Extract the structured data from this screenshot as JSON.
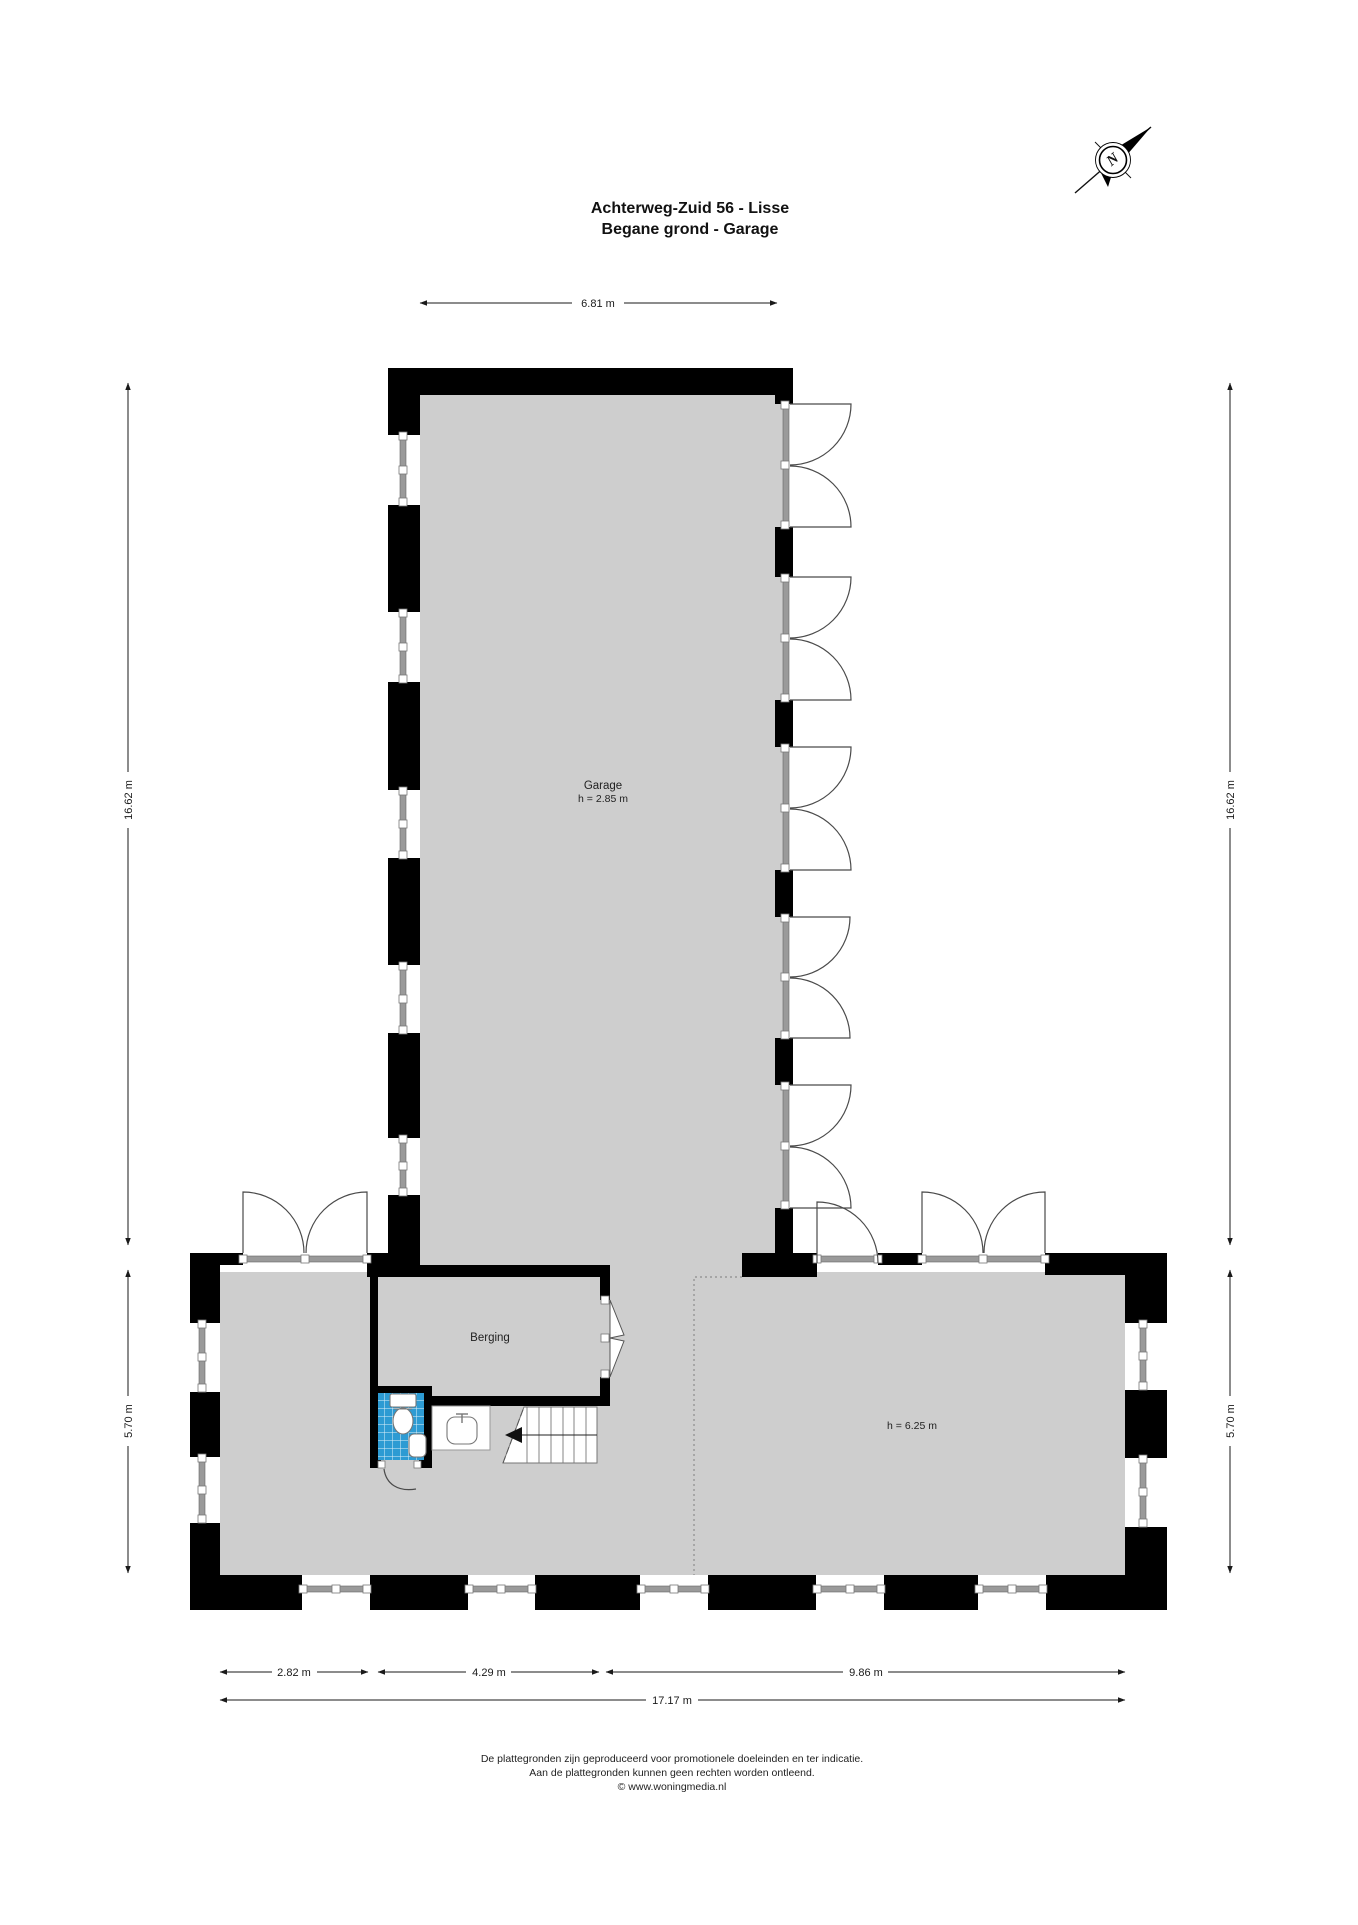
{
  "title": {
    "line1": "Achterweg-Zuid 56 - Lisse",
    "line2": "Begane grond - Garage"
  },
  "compass": {
    "north_label": "N"
  },
  "rooms": {
    "garage": {
      "name": "Garage",
      "height": "h = 2.85 m"
    },
    "berging": {
      "name": "Berging"
    },
    "hall": {
      "height": "h = 6.25 m"
    }
  },
  "dimensions": {
    "top": "6.81 m",
    "side_upper": "16.62 m",
    "side_lower": "5.70 m",
    "bottom_1": "2.82 m",
    "bottom_2": "4.29 m",
    "bottom_3": "9.86 m",
    "bottom_total": "17.17 m"
  },
  "footer": {
    "line1": "De plattegronden zijn geproduceerd voor promotionele doeleinden en ter indicatie.",
    "line2": "Aan de plattegronden kunnen geen rechten worden ontleend.",
    "line3": "© www.woningmedia.nl"
  },
  "colors": {
    "floor": "#cecece",
    "wall": "#000000",
    "tile": "#2d9bd3",
    "window_line": "#8a8a8a",
    "dim": "#1a1a1a",
    "door": "#4a4a4a"
  }
}
